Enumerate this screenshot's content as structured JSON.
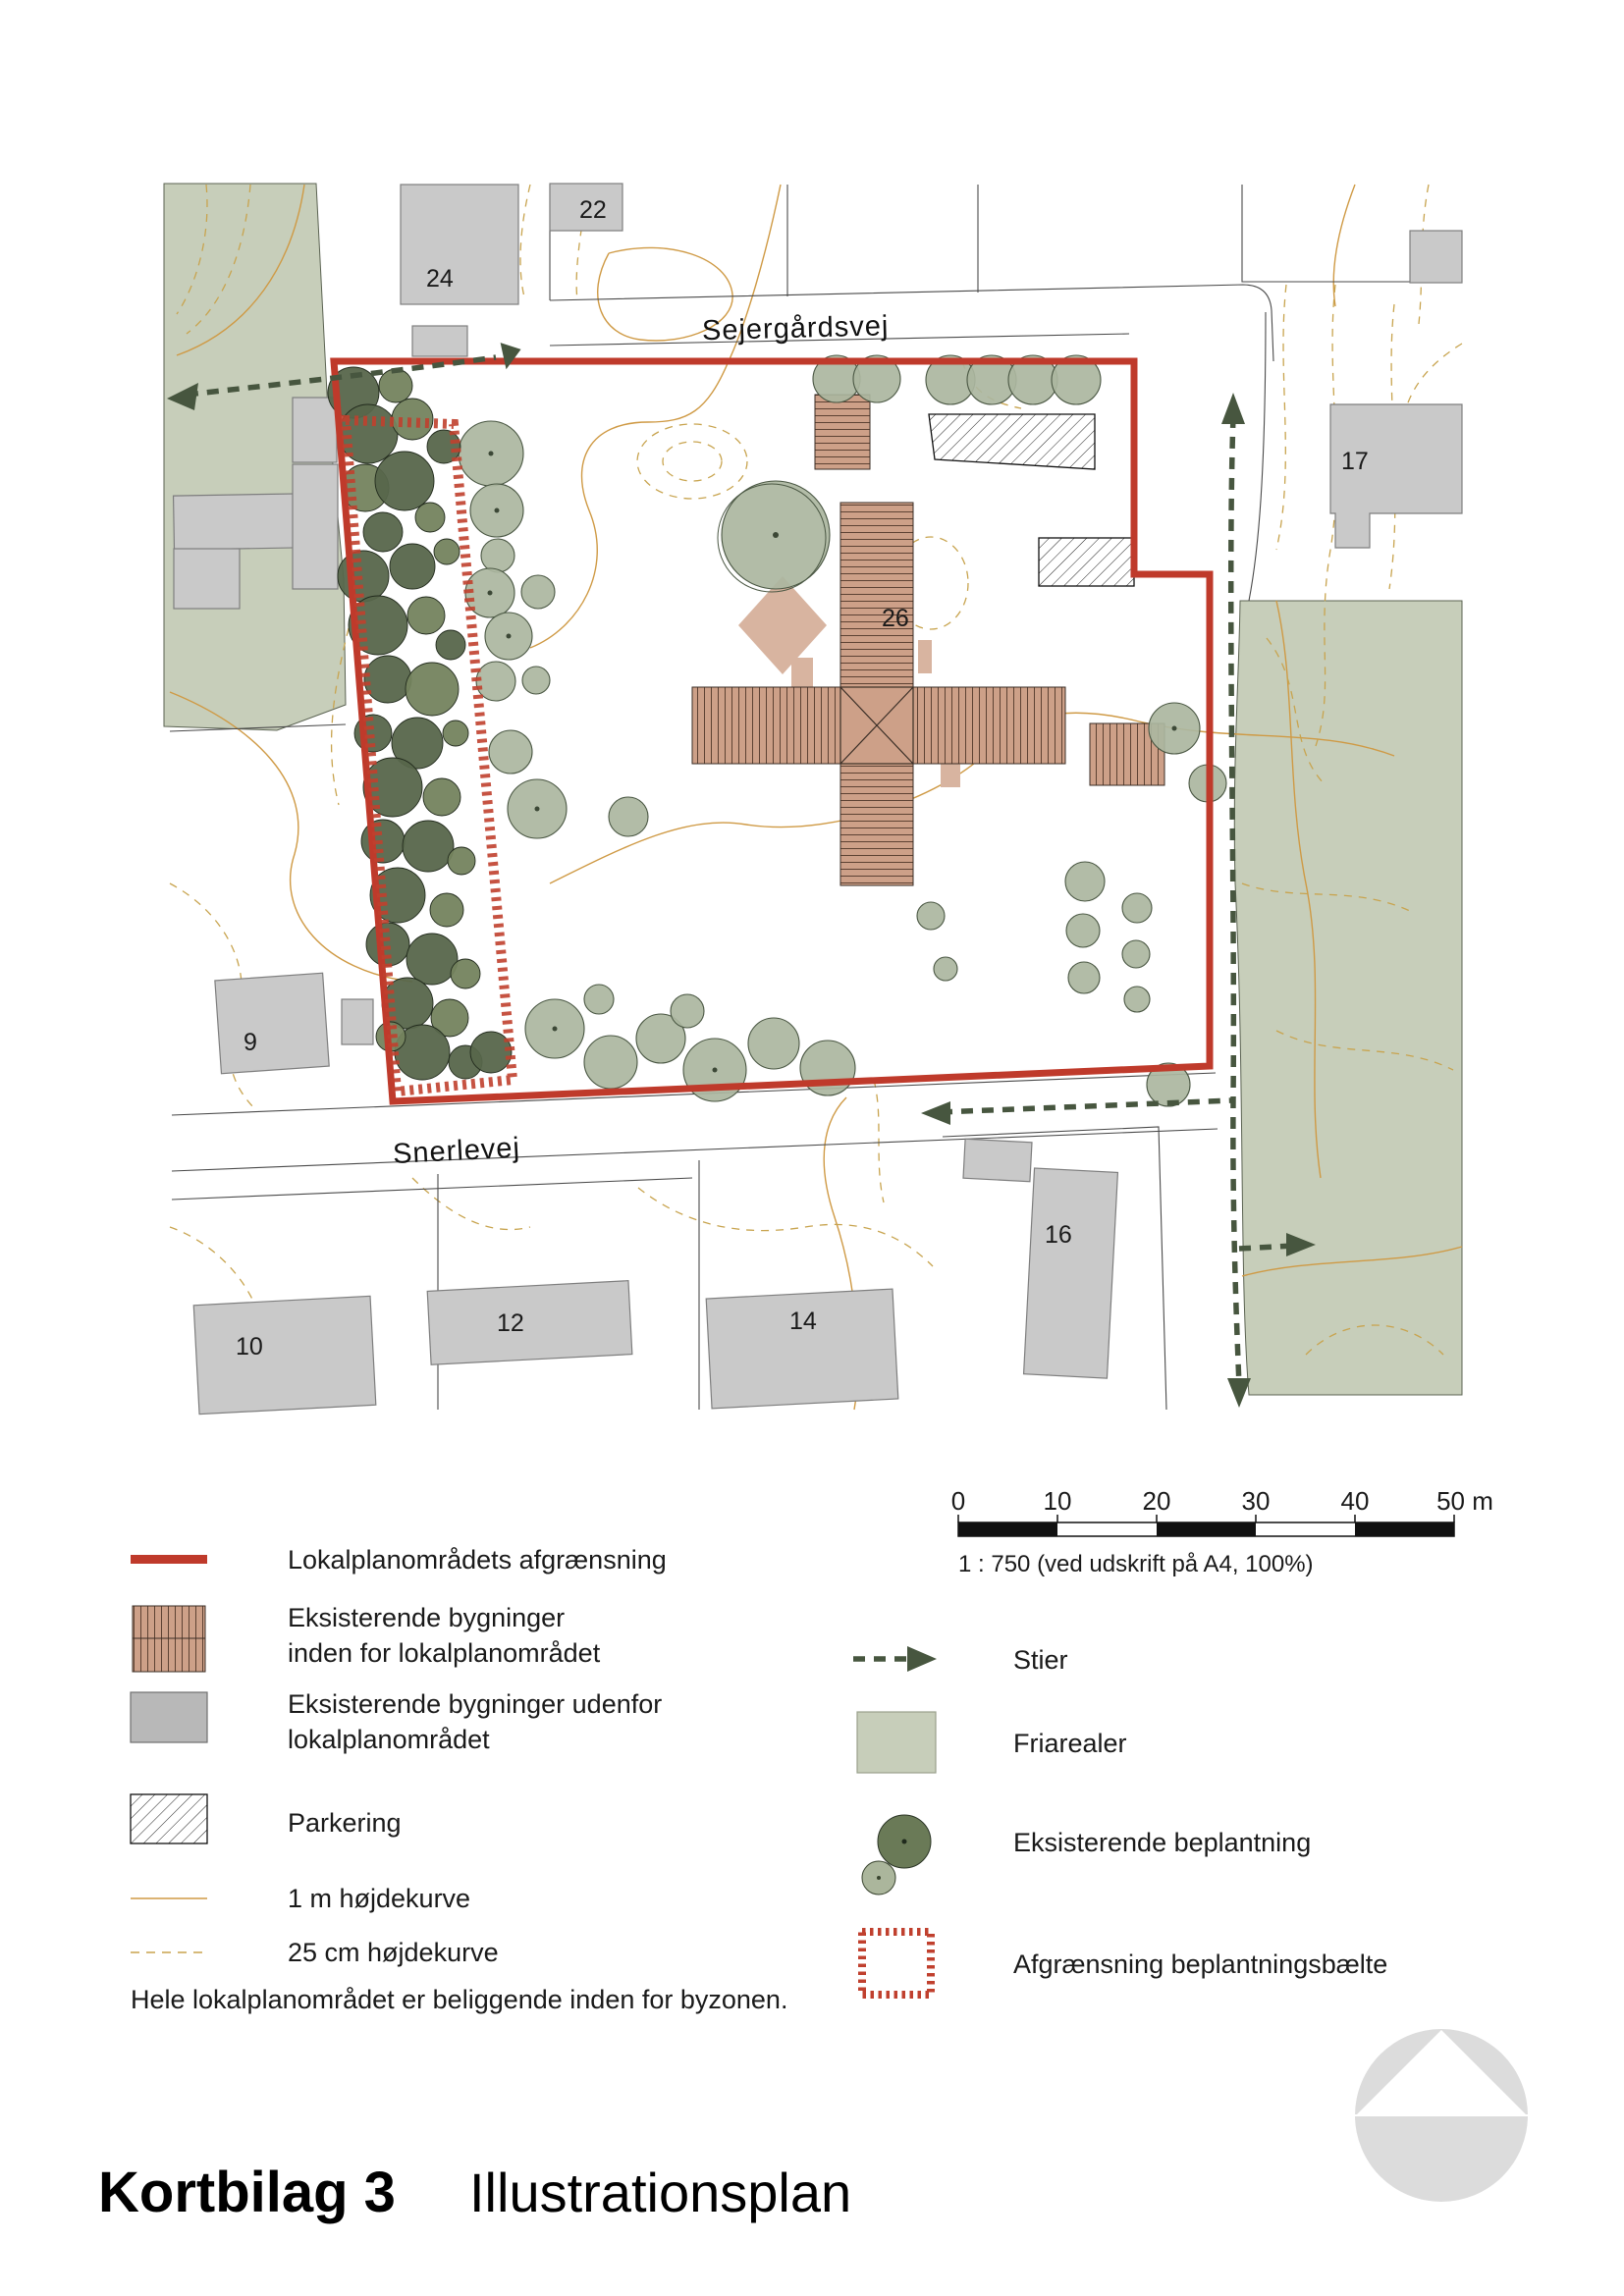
{
  "page": {
    "title_bold": "Kortbilag 3",
    "title_regular": "Illustrationsplan"
  },
  "map": {
    "streets": {
      "sejergardsvej": "Sejergårdsvej",
      "snerlevej": "Snerlevej"
    },
    "houses": [
      "22",
      "24",
      "17",
      "26",
      "9",
      "16",
      "10",
      "12",
      "14"
    ]
  },
  "legend": {
    "left": [
      {
        "label": "Lokalplanområdets afgrænsning"
      },
      {
        "label_line1": "Eksisterende bygninger",
        "label_line2": "inden for lokalplanområdet"
      },
      {
        "label_line1": "Eksisterende bygninger udenfor",
        "label_line2": "lokalplanområdet"
      },
      {
        "label": "Parkering"
      },
      {
        "label": "1 m højdekurve"
      },
      {
        "label": "25 cm højdekurve"
      }
    ],
    "right": [
      {
        "label": "Stier"
      },
      {
        "label": "Friarealer"
      },
      {
        "label": "Eksisterende beplantning"
      },
      {
        "label": "Afgrænsning beplantningsbælte"
      }
    ],
    "note": "Hele lokalplanområdet er beliggende inden for byzonen."
  },
  "scalebar": {
    "ticks": [
      "0",
      "10",
      "20",
      "30",
      "40",
      "50 m"
    ],
    "caption": "1 : 750 (ved udskrift på A4, 100%)"
  },
  "colors": {
    "plan_boundary_red": "#bf3a2b",
    "friareal_green": "#c7ceba",
    "existing_tree_dark": "#57664b",
    "existing_tree_light": "#abb6a0",
    "building_inside_brown": "#cda088",
    "building_outside_gray": "#c9c9c9",
    "contour_1m_orange": "#cf9a45",
    "contour_25cm_tan": "#c8a44f",
    "path_green": "#47563f"
  }
}
